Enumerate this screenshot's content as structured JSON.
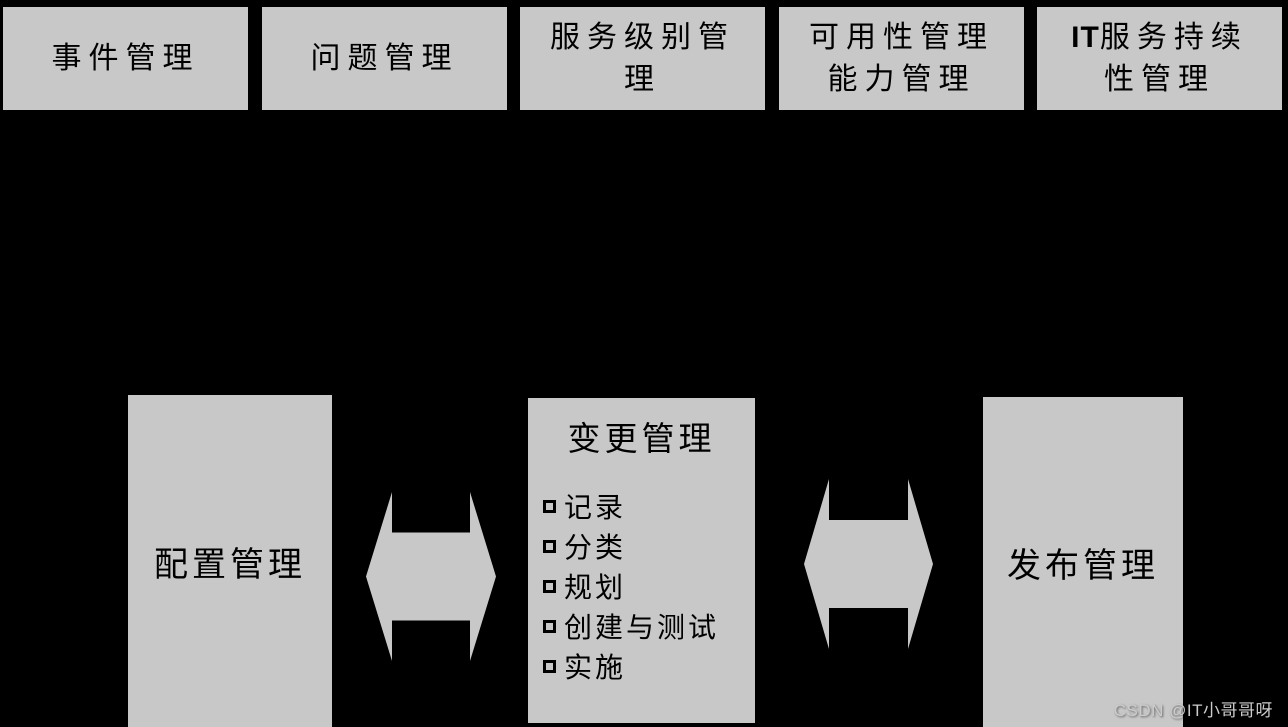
{
  "colors": {
    "background": "#000000",
    "box_fill": "#c8c8c8",
    "text": "#000000",
    "watermark": "#cccccc"
  },
  "top_row": {
    "items": [
      {
        "id": "incident-management",
        "lines": [
          "事件管理"
        ]
      },
      {
        "id": "problem-management",
        "lines": [
          "问题管理"
        ]
      },
      {
        "id": "service-level-management",
        "lines": [
          "服务级别管",
          "理"
        ]
      },
      {
        "id": "availability-capacity-management",
        "lines": [
          "可用性管理",
          "能力管理"
        ]
      },
      {
        "id": "it-service-continuity-management",
        "lines": [
          "IT服务持续",
          "性管理"
        ]
      }
    ]
  },
  "config_box": {
    "label": "配置管理"
  },
  "change_box": {
    "title": "变更管理",
    "bullet_icon": "square-bullet-icon",
    "items": [
      "记录",
      "分类",
      "规划",
      "创建与测试",
      "实施"
    ]
  },
  "release_box": {
    "label": "发布管理"
  },
  "arrows": {
    "left_arrow": {
      "icon": "left-right-arrow-icon",
      "between": [
        "配置管理",
        "变更管理"
      ]
    },
    "right_arrow": {
      "icon": "left-right-arrow-icon",
      "between": [
        "变更管理",
        "发布管理"
      ]
    }
  },
  "watermark": {
    "text": "CSDN @IT小哥哥呀"
  }
}
